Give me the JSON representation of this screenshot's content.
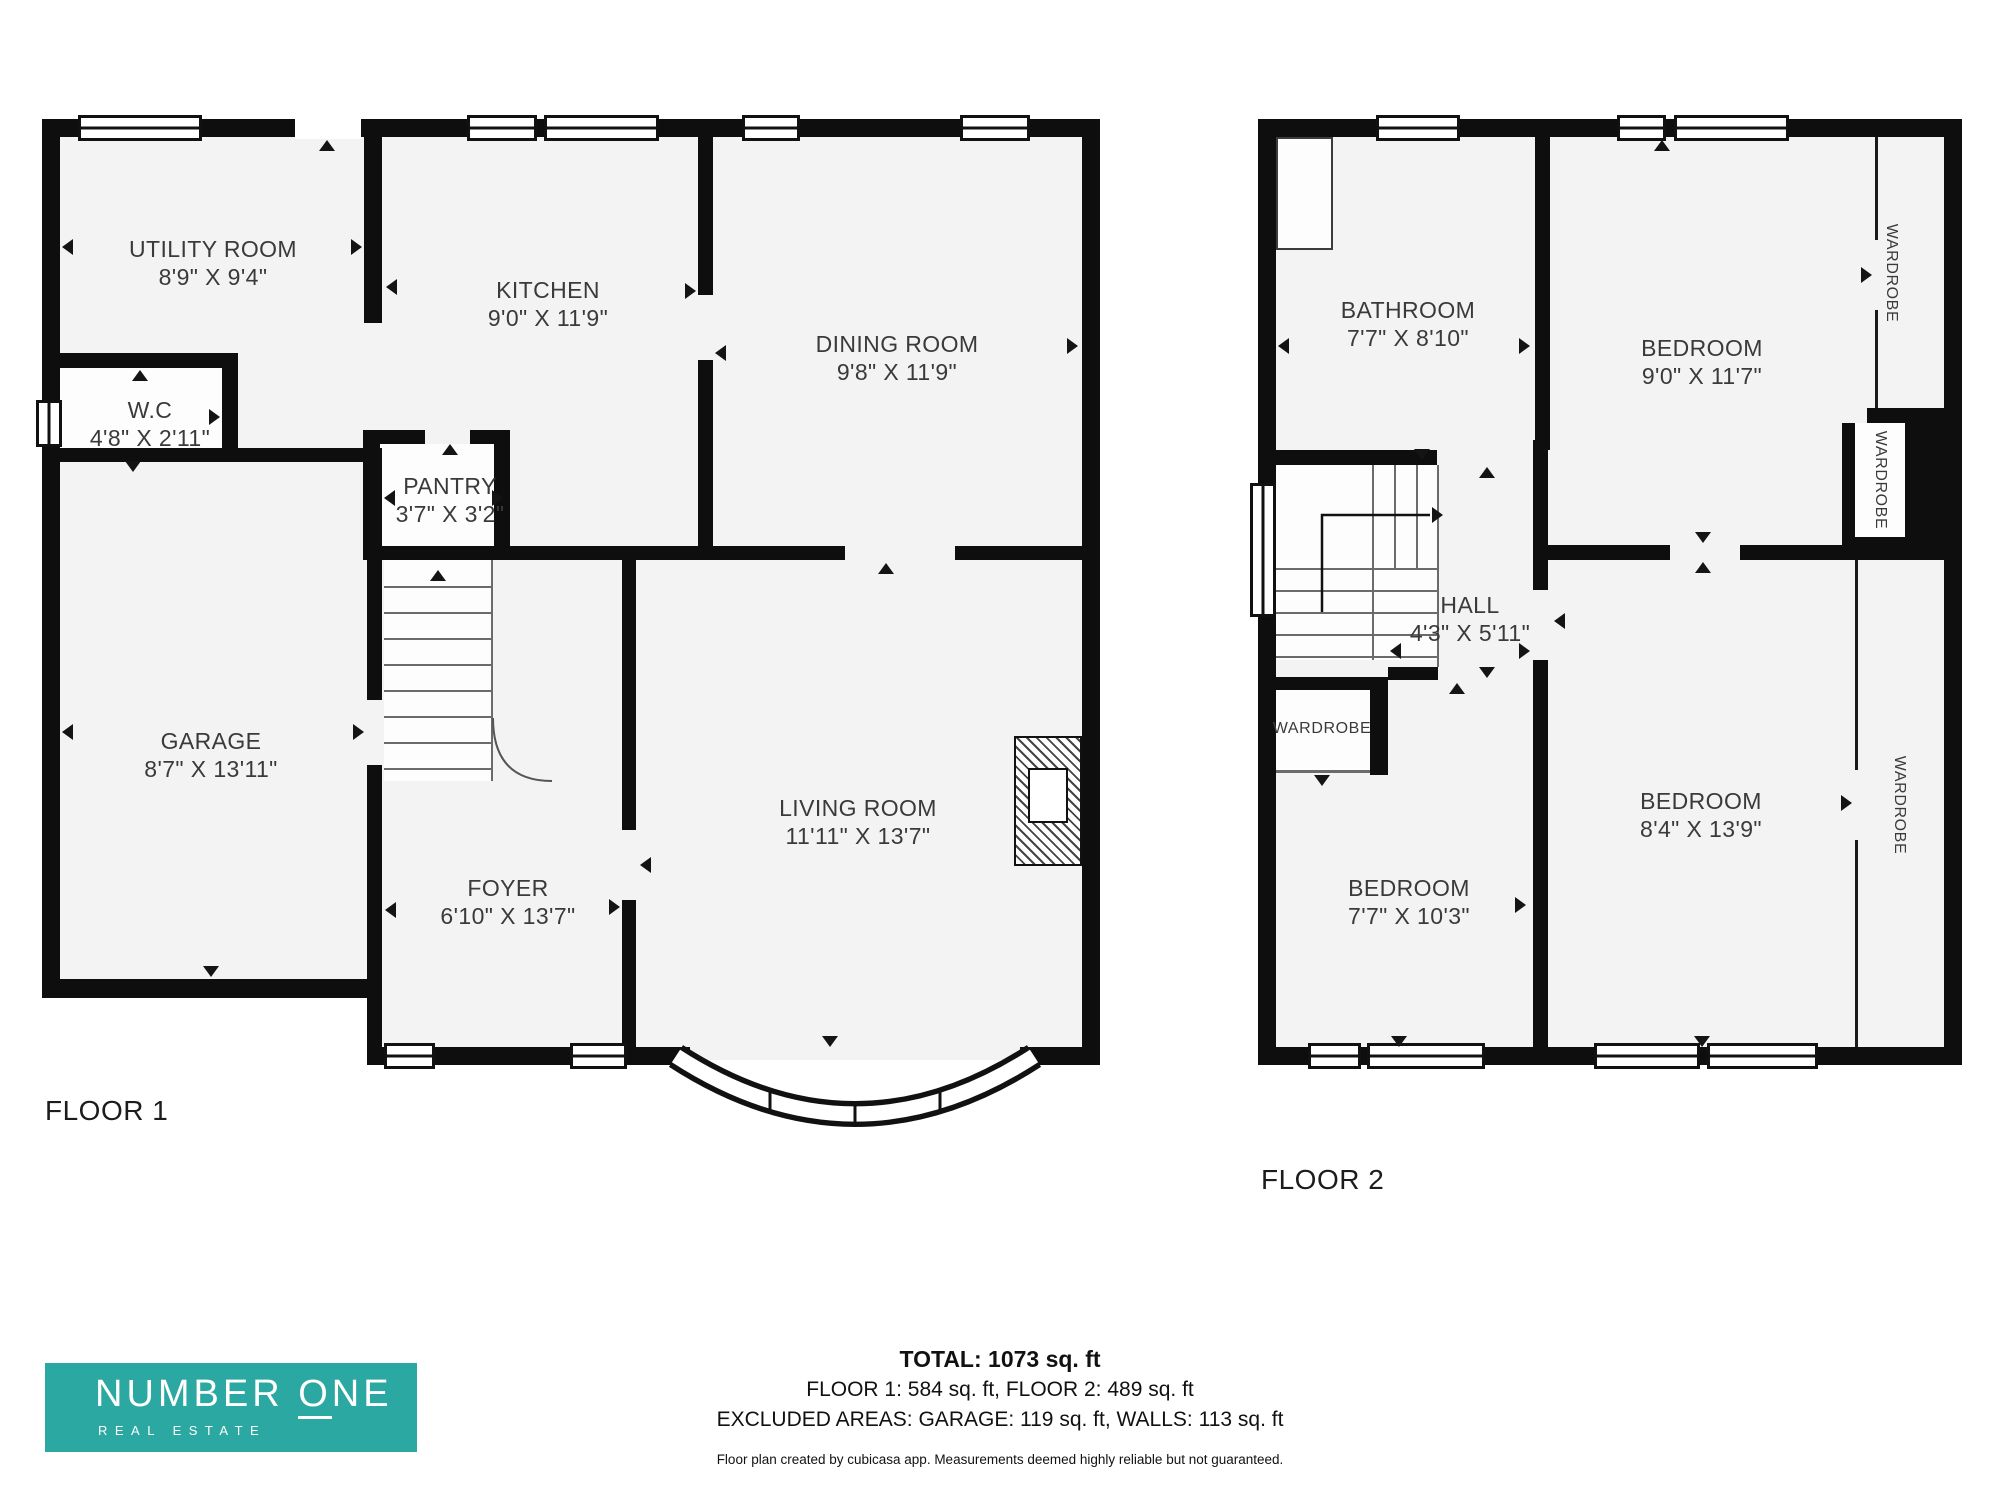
{
  "floor1": {
    "caption": "FLOOR 1",
    "rooms": {
      "utility_room": {
        "name": "UTILITY ROOM",
        "dims": "8'9\" X 9'4\""
      },
      "wc": {
        "name": "W.C",
        "dims": "4'8\" X 2'11\""
      },
      "kitchen": {
        "name": "KITCHEN",
        "dims": "9'0\" X 11'9\""
      },
      "dining_room": {
        "name": "DINING ROOM",
        "dims": "9'8\" X 11'9\""
      },
      "pantry": {
        "name": "PANTRY",
        "dims": "3'7\" X 3'2\""
      },
      "garage": {
        "name": "GARAGE",
        "dims": "8'7\" X 13'11\""
      },
      "foyer": {
        "name": "FOYER",
        "dims": "6'10\" X 13'7\""
      },
      "living_room": {
        "name": "LIVING ROOM",
        "dims": "11'11\" X 13'7\""
      }
    }
  },
  "floor2": {
    "caption": "FLOOR 2",
    "rooms": {
      "bathroom": {
        "name": "BATHROOM",
        "dims": "7'7\" X 8'10\""
      },
      "bedroom_top": {
        "name": "BEDROOM",
        "dims": "9'0\" X 11'7\""
      },
      "hall": {
        "name": "HALL",
        "dims": "4'3\" X 5'11\""
      },
      "bedroom_left": {
        "name": "BEDROOM",
        "dims": "7'7\" X 10'3\""
      },
      "bedroom_right": {
        "name": "BEDROOM",
        "dims": "8'4\" X 13'9\""
      },
      "wardrobe_top_right": {
        "name": "WARDROBE"
      },
      "wardrobe_mid_right": {
        "name": "WARDROBE"
      },
      "wardrobe_bottom_right": {
        "name": "WARDROBE"
      },
      "wardrobe_left": {
        "name": "WARDROBE"
      }
    }
  },
  "summary": {
    "total": "TOTAL: 1073 sq. ft",
    "floors": "FLOOR 1: 584 sq. ft, FLOOR 2: 489 sq. ft",
    "excluded": "EXCLUDED AREAS: GARAGE: 119 sq. ft, WALLS: 113 sq. ft",
    "disclaimer": "Floor plan created by cubicasa app. Measurements deemed highly reliable but not guaranteed."
  },
  "logo": {
    "brand_part1": "NUMBER ",
    "brand_o": "O",
    "brand_part2": "NE",
    "subtitle": "REAL ESTATE",
    "background": "#2ca8a2",
    "text_color": "#ffffff"
  },
  "colors": {
    "wall": "#0e0e0e",
    "room_fill": "#f3f3f3",
    "label_text": "#3a3a3a"
  }
}
